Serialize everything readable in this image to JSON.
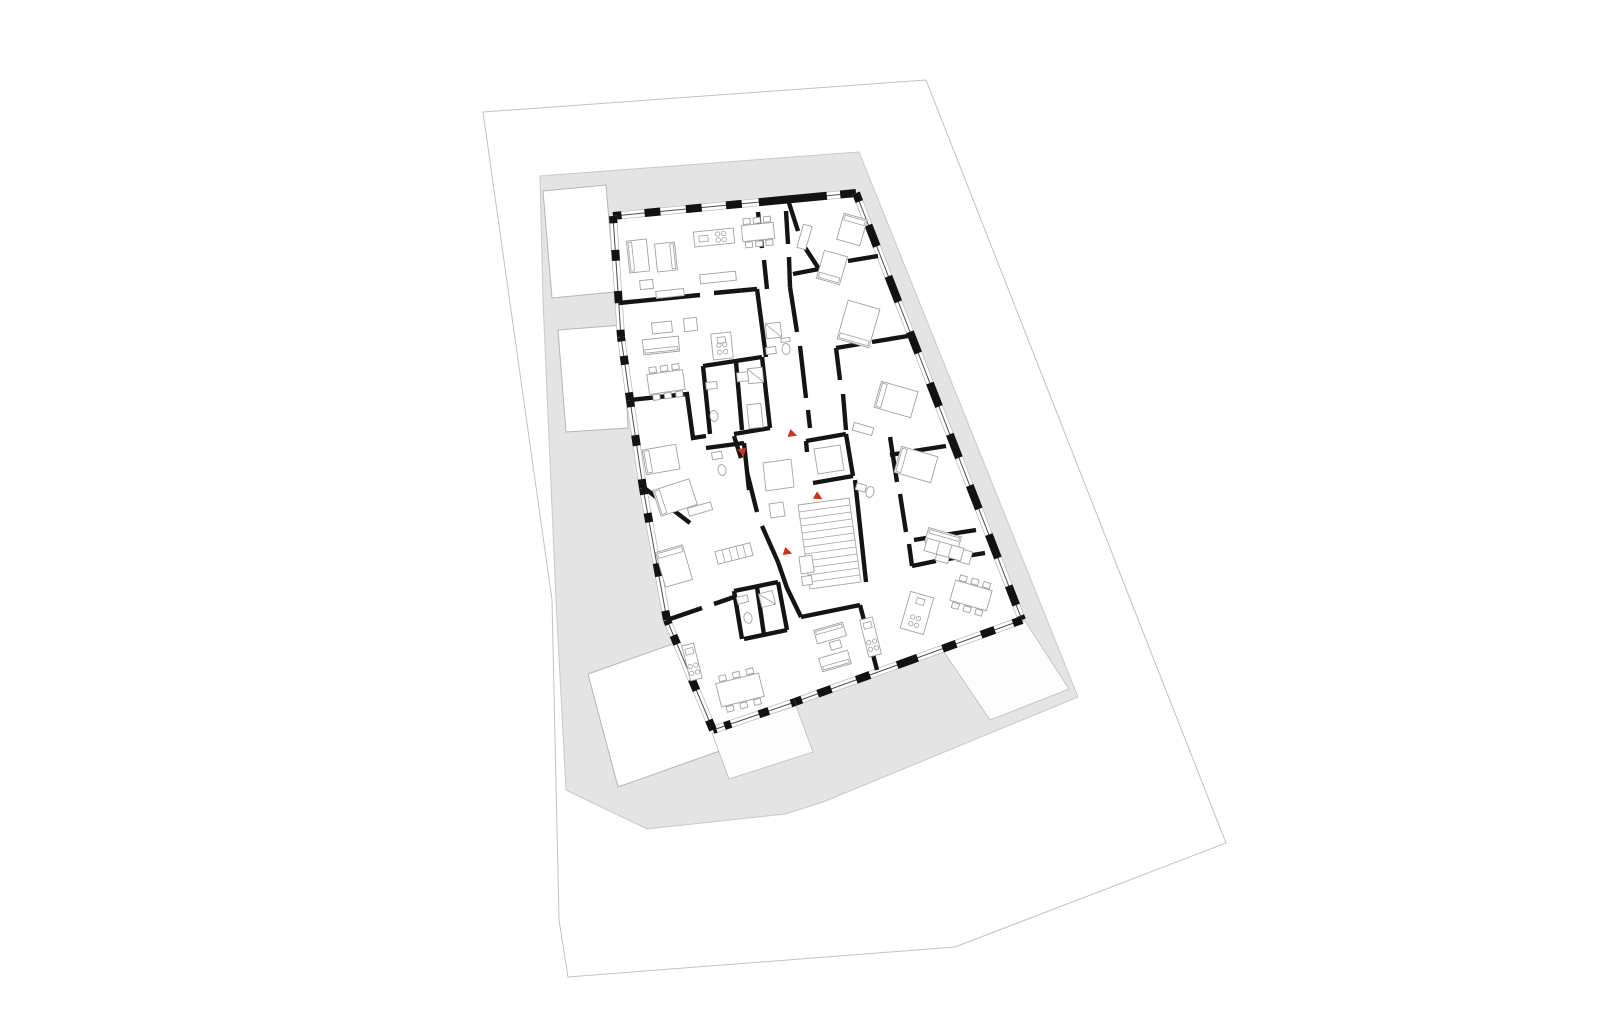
{
  "canvas": {
    "width": 1600,
    "height": 1030
  },
  "palette": {
    "background": "#ffffff",
    "site_line": "#c2c2c2",
    "terrain_fill": "#e4e4e4",
    "terrain_line": "#c9c9c9",
    "wall": "#141414",
    "window_line": "#4f4f4f",
    "furniture_line": "#a2a2a2",
    "entry_marker_red": "#d32f1e"
  },
  "site": {
    "boundary": [
      [
        483,
        112
      ],
      [
        926,
        80
      ],
      [
        1226,
        843
      ],
      [
        955,
        947
      ],
      [
        568,
        977
      ],
      [
        559,
        920
      ],
      [
        552,
        600
      ]
    ]
  },
  "terrain": {
    "outline": [
      [
        540,
        176
      ],
      [
        859,
        152
      ],
      [
        1078,
        697
      ],
      [
        823,
        802
      ],
      [
        785,
        814
      ],
      [
        647,
        829
      ],
      [
        566,
        790
      ],
      [
        556,
        600
      ],
      [
        543,
        300
      ]
    ]
  },
  "neighbors": [
    {
      "name": "neighbor-block-top-left",
      "points": [
        [
          543,
          191
        ],
        [
          606,
          185
        ],
        [
          615,
          292
        ],
        [
          552,
          298
        ]
      ]
    },
    {
      "name": "neighbor-block-mid-left",
      "points": [
        [
          558,
          330
        ],
        [
          623,
          325
        ],
        [
          628,
          428
        ],
        [
          566,
          432
        ]
      ]
    },
    {
      "name": "neighbor-block-bottom-left",
      "points": [
        [
          588,
          674
        ],
        [
          701,
          634
        ],
        [
          731,
          747
        ],
        [
          618,
          787
        ]
      ]
    }
  ],
  "terraces": [
    {
      "name": "terrace-south",
      "points": [
        [
          712,
          733
        ],
        [
          796,
          706
        ],
        [
          813,
          752
        ],
        [
          729,
          779
        ]
      ]
    },
    {
      "name": "terrace-east",
      "points": [
        [
          944,
          652
        ],
        [
          1025,
          621
        ],
        [
          1069,
          689
        ],
        [
          990,
          720
        ]
      ]
    }
  ],
  "building": {
    "outline": [
      [
        613,
        216
      ],
      [
        856,
        193
      ],
      [
        1022,
        620
      ],
      [
        795,
        702
      ],
      [
        713,
        730
      ],
      [
        667,
        620
      ],
      [
        643,
        488
      ],
      [
        630,
        400
      ],
      [
        621,
        337
      ]
    ],
    "facades": [
      {
        "a": [
          613,
          216
        ],
        "b": [
          856,
          193
        ],
        "s": [
          [
            0,
            0.035
          ],
          [
            0.13,
            0.195
          ],
          [
            0.3,
            0.365
          ],
          [
            0.465,
            0.53
          ],
          [
            0.6,
            0.88
          ],
          [
            0.935,
            1
          ]
        ]
      },
      {
        "a": [
          856,
          193
        ],
        "b": [
          1022,
          620
        ],
        "s": [
          [
            0,
            0.02
          ],
          [
            0.075,
            0.125
          ],
          [
            0.195,
            0.255
          ],
          [
            0.325,
            0.375
          ],
          [
            0.445,
            0.5
          ],
          [
            0.565,
            0.62
          ],
          [
            0.685,
            0.74
          ],
          [
            0.8,
            0.855
          ],
          [
            0.92,
            0.965
          ],
          [
            0.99,
            1
          ]
        ]
      },
      {
        "a": [
          1022,
          620
        ],
        "b": [
          795,
          702
        ],
        "s": [
          [
            0,
            0.04
          ],
          [
            0.12,
            0.18
          ],
          [
            0.29,
            0.35
          ],
          [
            0.46,
            0.55
          ],
          [
            0.67,
            0.73
          ],
          [
            0.84,
            0.9
          ],
          [
            0.97,
            1
          ]
        ]
      },
      {
        "a": [
          795,
          702
        ],
        "b": [
          713,
          730
        ],
        "s": [
          [
            0,
            0.05
          ],
          [
            0.32,
            0.44
          ],
          [
            0.78,
            0.86
          ],
          [
            0.96,
            1
          ]
        ]
      },
      {
        "a": [
          713,
          730
        ],
        "b": [
          667,
          620
        ],
        "s": [
          [
            0,
            0.09
          ],
          [
            0.36,
            0.46
          ],
          [
            0.78,
            0.86
          ],
          [
            0.96,
            1
          ]
        ]
      },
      {
        "a": [
          667,
          620
        ],
        "b": [
          643,
          488
        ],
        "s": [
          [
            0,
            0.07
          ],
          [
            0.33,
            0.43
          ],
          [
            0.74,
            0.81
          ],
          [
            0.95,
            1
          ]
        ]
      },
      {
        "a": [
          643,
          488
        ],
        "b": [
          630,
          400
        ],
        "s": [
          [
            0,
            0.1
          ],
          [
            0.48,
            0.6
          ],
          [
            0.92,
            1
          ]
        ]
      },
      {
        "a": [
          630,
          400
        ],
        "b": [
          621,
          337
        ],
        "s": [
          [
            0,
            0.12
          ],
          [
            0.56,
            0.7
          ],
          [
            0.93,
            1
          ]
        ]
      },
      {
        "a": [
          621,
          337
        ],
        "b": [
          613,
          216
        ],
        "s": [
          [
            0,
            0.06
          ],
          [
            0.28,
            0.38
          ],
          [
            0.63,
            0.72
          ],
          [
            0.94,
            1
          ]
        ]
      }
    ]
  },
  "interior_walls": [
    [
      [
        619,
        303
      ],
      [
        700,
        295
      ]
    ],
    [
      [
        714,
        293
      ],
      [
        757,
        289
      ]
    ],
    [
      [
        758,
        212
      ],
      [
        762,
        248
      ]
    ],
    [
      [
        764,
        260
      ],
      [
        767,
        289
      ]
    ],
    [
      [
        786,
        211
      ],
      [
        788,
        244
      ]
    ],
    [
      [
        789,
        257
      ],
      [
        790,
        287
      ]
    ],
    [
      [
        757,
        289
      ],
      [
        766,
        357
      ]
    ],
    [
      [
        790,
        287
      ],
      [
        797,
        332
      ]
    ],
    [
      [
        800,
        346
      ],
      [
        806,
        398
      ]
    ],
    [
      [
        808,
        410
      ],
      [
        810,
        428
      ]
    ],
    [
      [
        703,
        366
      ],
      [
        762,
        357
      ]
    ],
    [
      [
        762,
        357
      ],
      [
        770,
        428
      ]
    ],
    [
      [
        770,
        428
      ],
      [
        734,
        434
      ]
    ],
    [
      [
        703,
        366
      ],
      [
        710,
        434
      ]
    ],
    [
      [
        736,
        362
      ],
      [
        742,
        430
      ]
    ],
    [
      [
        734,
        436
      ],
      [
        741,
        458
      ]
    ],
    [
      [
        747,
        472
      ],
      [
        757,
        512
      ]
    ],
    [
      [
        762,
        526
      ],
      [
        778,
        562
      ]
    ],
    [
      [
        778,
        562
      ],
      [
        787,
        588
      ],
      [
        801,
        617
      ]
    ],
    [
      [
        801,
        617
      ],
      [
        860,
        605
      ]
    ],
    [
      [
        860,
        605
      ],
      [
        877,
        670
      ]
    ],
    [
      [
        855,
        480
      ],
      [
        866,
        582
      ]
    ],
    [
      [
        806,
        441
      ],
      [
        846,
        434
      ]
    ],
    [
      [
        846,
        434
      ],
      [
        853,
        476
      ]
    ],
    [
      [
        853,
        476
      ],
      [
        813,
        483
      ]
    ],
    [
      [
        806,
        441
      ],
      [
        807,
        452
      ]
    ],
    [
      [
        789,
        203
      ],
      [
        798,
        231
      ]
    ],
    [
      [
        802,
        243
      ],
      [
        819,
        269
      ]
    ],
    [
      [
        819,
        269
      ],
      [
        793,
        274
      ]
    ],
    [
      [
        878,
        256
      ],
      [
        848,
        261
      ]
    ],
    [
      [
        836,
        263
      ],
      [
        824,
        266
      ]
    ],
    [
      [
        908,
        336
      ],
      [
        872,
        342
      ]
    ],
    [
      [
        860,
        344
      ],
      [
        836,
        348
      ]
    ],
    [
      [
        836,
        348
      ],
      [
        840,
        380
      ]
    ],
    [
      [
        843,
        394
      ],
      [
        846,
        430
      ]
    ],
    [
      [
        946,
        446
      ],
      [
        914,
        451
      ]
    ],
    [
      [
        902,
        453
      ],
      [
        890,
        455
      ]
    ],
    [
      [
        890,
        437
      ],
      [
        897,
        482
      ]
    ],
    [
      [
        900,
        494
      ],
      [
        906,
        532
      ]
    ],
    [
      [
        909,
        544
      ],
      [
        912,
        566
      ]
    ],
    [
      [
        976,
        530
      ],
      [
        944,
        535
      ]
    ],
    [
      [
        932,
        537
      ],
      [
        914,
        540
      ]
    ],
    [
      [
        985,
        553
      ],
      [
        948,
        559
      ]
    ],
    [
      [
        936,
        561
      ],
      [
        912,
        566
      ]
    ],
    [
      [
        630,
        400
      ],
      [
        687,
        394
      ],
      [
        693,
        438
      ],
      [
        706,
        436
      ]
    ],
    [
      [
        643,
        487
      ],
      [
        690,
        523
      ]
    ],
    [
      [
        706,
        448
      ],
      [
        744,
        443
      ]
    ],
    [
      [
        744,
        443
      ],
      [
        749,
        490
      ]
    ],
    [
      [
        667,
        620
      ],
      [
        702,
        608
      ]
    ],
    [
      [
        714,
        604
      ],
      [
        734,
        597
      ]
    ],
    [
      [
        734,
        591
      ],
      [
        778,
        582
      ]
    ],
    [
      [
        778,
        582
      ],
      [
        787,
        630
      ]
    ],
    [
      [
        787,
        630
      ],
      [
        744,
        639
      ]
    ],
    [
      [
        734,
        591
      ],
      [
        742,
        639
      ]
    ],
    [
      [
        757,
        587
      ],
      [
        764,
        635
      ]
    ]
  ],
  "core": {
    "stair": {
      "quad": [
        [
          798,
          505
        ],
        [
          849,
          498
        ],
        [
          861,
          582
        ],
        [
          810,
          589
        ]
      ],
      "treads": 11
    },
    "elevator_car": [
      [
        814,
        449
      ],
      [
        840,
        445
      ],
      [
        844,
        470
      ],
      [
        818,
        474
      ]
    ],
    "landings": [
      [
        [
          763,
          463
        ],
        [
          791,
          459
        ],
        [
          794,
          487
        ],
        [
          766,
          491
        ]
      ],
      [
        [
          769,
          504
        ],
        [
          783,
          502
        ],
        [
          785,
          516
        ],
        [
          771,
          518
        ]
      ]
    ]
  },
  "furniture": [
    {
      "t": "sofa",
      "x": 628,
      "y": 240,
      "w": 20,
      "h": 32,
      "r": -6,
      "back": "l"
    },
    {
      "t": "sofa",
      "x": 656,
      "y": 243,
      "w": 20,
      "h": 28,
      "r": -6,
      "back": "r"
    },
    {
      "t": "rect",
      "x": 640,
      "y": 280,
      "w": 13,
      "h": 9,
      "r": -6
    },
    {
      "t": "kitchen",
      "x": 694,
      "y": 230,
      "w": 40,
      "h": 15,
      "r": -6
    },
    {
      "t": "rect",
      "x": 700,
      "y": 273,
      "w": 36,
      "h": 9,
      "r": -6
    },
    {
      "t": "table",
      "x": 742,
      "y": 224,
      "w": 32,
      "h": 16,
      "r": -6
    },
    {
      "t": "rect",
      "x": 656,
      "y": 290,
      "w": 28,
      "h": 7,
      "r": -6
    },
    {
      "t": "rect",
      "x": 684,
      "y": 318,
      "w": 13,
      "h": 13,
      "r": -6
    },
    {
      "t": "rect",
      "x": 652,
      "y": 322,
      "w": 20,
      "h": 11,
      "r": -6
    },
    {
      "t": "sofa",
      "x": 643,
      "y": 338,
      "w": 36,
      "h": 15,
      "r": -6,
      "back": "b"
    },
    {
      "t": "table",
      "x": 648,
      "y": 372,
      "w": 36,
      "h": 20,
      "r": -8
    },
    {
      "t": "kitchen",
      "x": 712,
      "y": 333,
      "w": 20,
      "h": 26,
      "r": -6
    },
    {
      "t": "rect",
      "x": 737,
      "y": 372,
      "w": 18,
      "h": 9,
      "r": -6
    },
    {
      "t": "bed",
      "x": 644,
      "y": 447,
      "w": 34,
      "h": 25,
      "r": -10,
      "head": "l"
    },
    {
      "t": "rect",
      "x": 688,
      "y": 505,
      "w": 24,
      "h": 8,
      "r": -16
    },
    {
      "t": "bed",
      "x": 656,
      "y": 484,
      "w": 38,
      "h": 27,
      "r": -18,
      "head": "l"
    },
    {
      "t": "bed",
      "x": 660,
      "y": 548,
      "w": 28,
      "h": 36,
      "r": -16,
      "head": "t"
    },
    {
      "t": "hrect",
      "x": 716,
      "y": 547,
      "w": 36,
      "h": 13,
      "r": -14,
      "n": 5
    },
    {
      "t": "kitchen",
      "x": 686,
      "y": 644,
      "w": 12,
      "h": 36,
      "r": -14
    },
    {
      "t": "table",
      "x": 718,
      "y": 678,
      "w": 44,
      "h": 24,
      "r": -14
    },
    {
      "t": "bed",
      "x": 840,
      "y": 216,
      "w": 24,
      "h": 27,
      "r": 16,
      "head": "t"
    },
    {
      "t": "bed",
      "x": 820,
      "y": 253,
      "w": 24,
      "h": 29,
      "r": 16,
      "head": "b"
    },
    {
      "t": "bed",
      "x": 842,
      "y": 304,
      "w": 33,
      "h": 40,
      "r": 16,
      "head": "b"
    },
    {
      "t": "rect",
      "x": 800,
      "y": 225,
      "w": 9,
      "h": 24,
      "r": 16
    },
    {
      "t": "rect",
      "x": 766,
      "y": 323,
      "w": 15,
      "h": 15,
      "r": -6,
      "diag": true
    },
    {
      "t": "ell",
      "x": 786,
      "y": 349,
      "rx": 4,
      "ry": 5.5,
      "r": -6
    },
    {
      "t": "rect",
      "x": 781,
      "y": 338,
      "w": 9,
      "h": 4,
      "r": -6
    },
    {
      "t": "rect",
      "x": 766,
      "y": 347,
      "w": 10,
      "h": 7,
      "r": -6
    },
    {
      "t": "bed",
      "x": 877,
      "y": 386,
      "w": 38,
      "h": 27,
      "r": 16,
      "head": "l"
    },
    {
      "t": "rect",
      "x": 853,
      "y": 425,
      "w": 20,
      "h": 8,
      "r": 16
    },
    {
      "t": "bed",
      "x": 897,
      "y": 451,
      "w": 38,
      "h": 27,
      "r": 16,
      "head": "l"
    },
    {
      "t": "sofa",
      "x": 926,
      "y": 532,
      "w": 34,
      "h": 15,
      "r": 16,
      "back": "t"
    },
    {
      "t": "rect",
      "x": 958,
      "y": 550,
      "w": 13,
      "h": 13,
      "r": 16
    },
    {
      "t": "rect",
      "x": 936,
      "y": 553,
      "w": 13,
      "h": 9,
      "r": 16
    },
    {
      "t": "ell",
      "x": 870,
      "y": 492,
      "rx": 4,
      "ry": 5.5,
      "r": 16
    },
    {
      "t": "rect",
      "x": 856,
      "y": 484,
      "w": 10,
      "h": 7,
      "r": 16
    },
    {
      "t": "sofa",
      "x": 815,
      "y": 626,
      "w": 30,
      "h": 14,
      "r": -16,
      "back": "t"
    },
    {
      "t": "sofa",
      "x": 820,
      "y": 654,
      "w": 30,
      "h": 14,
      "r": -16,
      "back": "b"
    },
    {
      "t": "rect",
      "x": 830,
      "y": 641,
      "w": 11,
      "h": 8,
      "r": -16
    },
    {
      "t": "kitchen",
      "x": 864,
      "y": 618,
      "w": 13,
      "h": 38,
      "r": -14
    },
    {
      "t": "kitchen",
      "x": 905,
      "y": 594,
      "w": 24,
      "h": 38,
      "r": 16
    },
    {
      "t": "table",
      "x": 952,
      "y": 585,
      "w": 38,
      "h": 21,
      "r": 16
    },
    {
      "t": "hrect",
      "x": 925,
      "y": 543,
      "w": 38,
      "h": 13,
      "r": 16,
      "n": 3
    },
    {
      "t": "ell",
      "x": 748,
      "y": 618,
      "rx": 4,
      "ry": 5.5,
      "r": -14
    },
    {
      "t": "rect",
      "x": 737,
      "y": 596,
      "w": 11,
      "h": 7,
      "r": -14
    },
    {
      "t": "rect",
      "x": 760,
      "y": 592,
      "w": 14,
      "h": 14,
      "r": -14,
      "diag": true
    },
    {
      "t": "ell",
      "x": 714,
      "y": 416,
      "rx": 4,
      "ry": 5.5,
      "r": -6
    },
    {
      "t": "rect",
      "x": 706,
      "y": 382,
      "w": 11,
      "h": 7,
      "r": -6
    },
    {
      "t": "rect",
      "x": 748,
      "y": 368,
      "w": 15,
      "h": 15,
      "r": -6,
      "diag": true
    },
    {
      "t": "rect",
      "x": 748,
      "y": 404,
      "w": 14,
      "h": 24,
      "r": -6
    },
    {
      "t": "ell",
      "x": 722,
      "y": 470,
      "rx": 4,
      "ry": 5.5,
      "r": -10
    },
    {
      "t": "rect",
      "x": 712,
      "y": 452,
      "w": 10,
      "h": 7,
      "r": -10
    },
    {
      "t": "rect",
      "x": 800,
      "y": 556,
      "w": 13,
      "h": 17,
      "r": -8
    },
    {
      "t": "rect",
      "x": 802,
      "y": 576,
      "w": 10,
      "h": 9,
      "r": -8
    }
  ],
  "entry_markers": [
    {
      "x": 789,
      "y": 433,
      "rot": 18
    },
    {
      "x": 745,
      "y": 452,
      "rot": 198
    },
    {
      "x": 815,
      "y": 495,
      "rot": 30
    },
    {
      "x": 784,
      "y": 551,
      "rot": 18
    }
  ]
}
